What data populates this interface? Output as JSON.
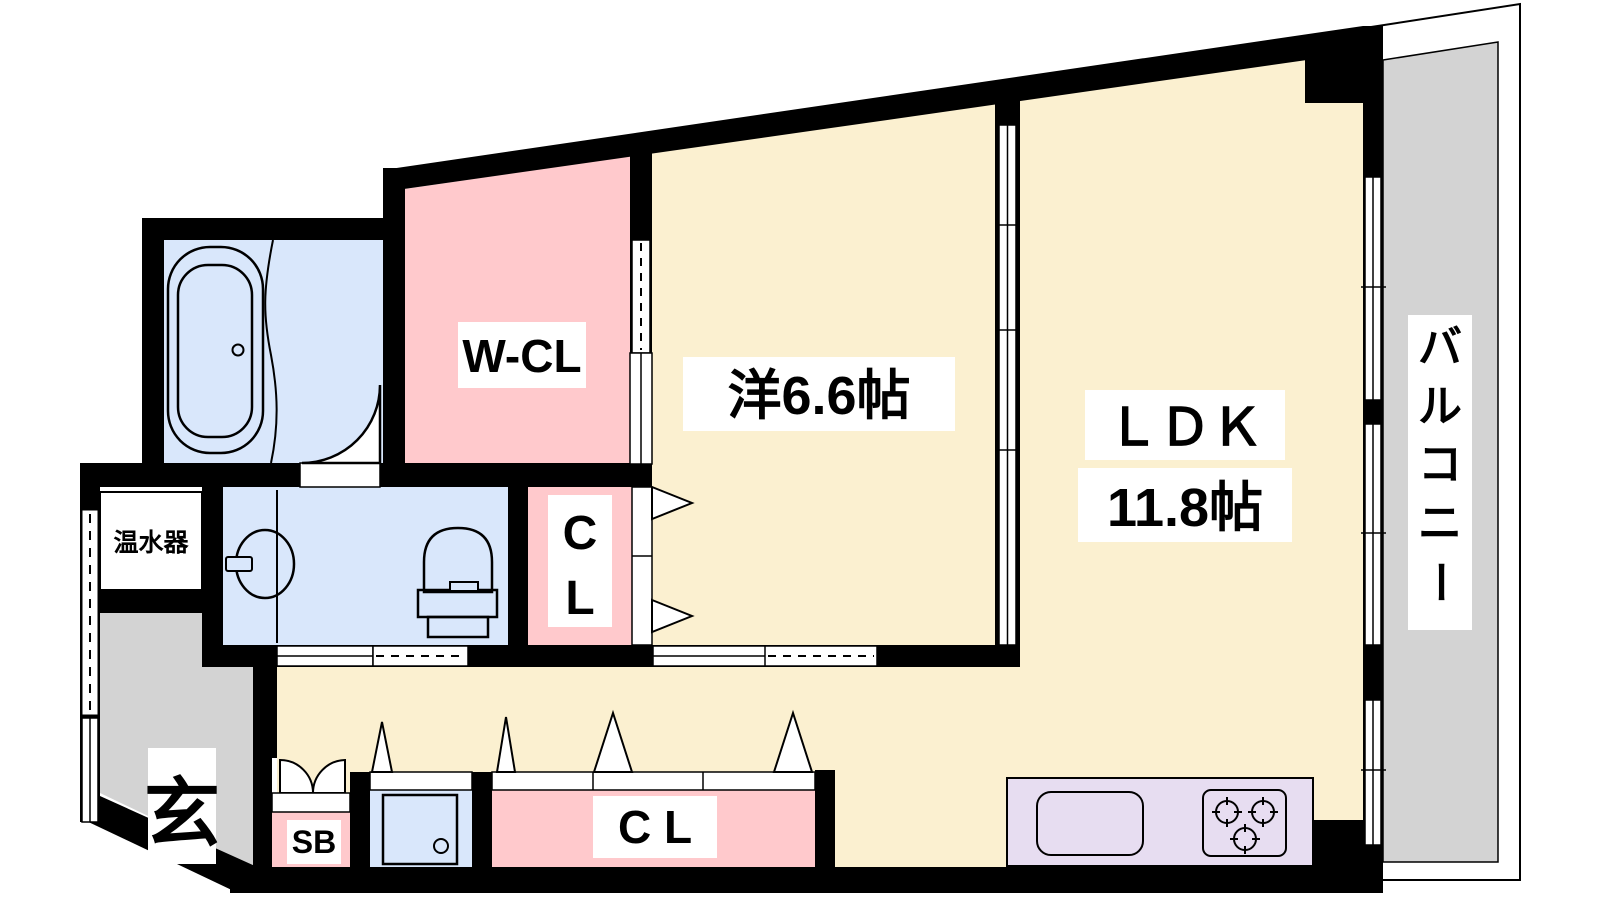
{
  "colors": {
    "wall": "#000000",
    "cream": "#FBF0D0",
    "pink": "#FFC9CC",
    "blue": "#D9E7FB",
    "gray": "#D3D3D3",
    "lavender": "#E7DDF1",
    "white": "#FFFFFF"
  },
  "rooms": {
    "walk_in_closet": {
      "label": "W-CL"
    },
    "western_room": {
      "label": "洋6.6帖"
    },
    "ldk": {
      "label_line1": "ＬＤＫ",
      "label_line2": "11.8帖"
    },
    "balcony": {
      "label": "バルコニー",
      "chars": [
        "バ",
        "ル",
        "コ",
        "ニ",
        "ー"
      ]
    },
    "closet_upper": {
      "chars": [
        "C",
        "L"
      ]
    },
    "closet_lower": {
      "label": "C L"
    },
    "shoe_box": {
      "label": "SB"
    },
    "water_heater": {
      "label": "温水器"
    },
    "entrance": {
      "label": "玄"
    }
  }
}
